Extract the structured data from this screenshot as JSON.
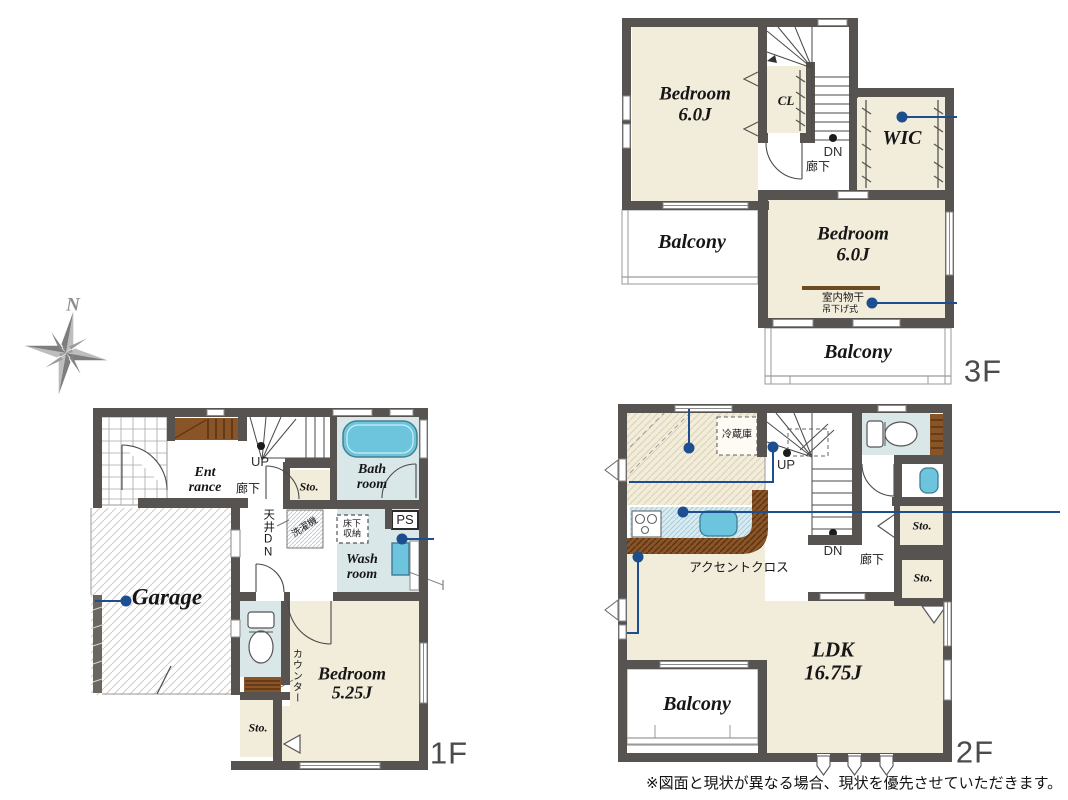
{
  "compass": {
    "north": "N"
  },
  "f3": {
    "label": "3F",
    "bedroom1_l1": "Bedroom",
    "bedroom1_l2": "6.0J",
    "cl": "CL",
    "wic": "WIC",
    "dn": "DN",
    "hall": "廊下",
    "balcony_left": "Balcony",
    "balcony_bottom": "Balcony",
    "bedroom2_l1": "Bedroom",
    "bedroom2_l2": "6.0J",
    "indoor_drying": "室内物干",
    "hanging_type": "吊下げ式"
  },
  "f1": {
    "label": "1F",
    "entrance_l1": "Ent",
    "entrance_l2": "rance",
    "up": "UP",
    "hall": "廊下",
    "sto_center": "Sto.",
    "bath_l1": "Bath",
    "bath_l2": "room",
    "ceiling_dn": "天井DN",
    "washer": "洗濯機",
    "underfloor_l1": "床下",
    "underfloor_l2": "収納",
    "ps": "PS",
    "wash_l1": "Wash",
    "wash_l2": "room",
    "garage": "Garage",
    "counter": "カウンター",
    "bedroom_l1": "Bedroom",
    "bedroom_l2": "5.25J",
    "sto_bottom": "Sto."
  },
  "f2": {
    "label": "2F",
    "fridge": "冷蔵庫",
    "up": "UP",
    "dn": "DN",
    "hall": "廊下",
    "accent": "アクセントクロス",
    "sto1": "Sto.",
    "sto2": "Sto.",
    "ldk_l1": "LDK",
    "ldk_l2": "16.75J",
    "balcony": "Balcony"
  },
  "page": {
    "disclaimer": "※図面と現状が異なる場合、現状を優先させていただきます。"
  },
  "colors": {
    "wall": "#565350",
    "room_cream": "#f2ecda",
    "wet_blue": "#dae7e9",
    "fixture_cyan": "#6cc5dc",
    "wood_brown": "#8a5429",
    "annotation_blue": "#1d4e8f"
  }
}
